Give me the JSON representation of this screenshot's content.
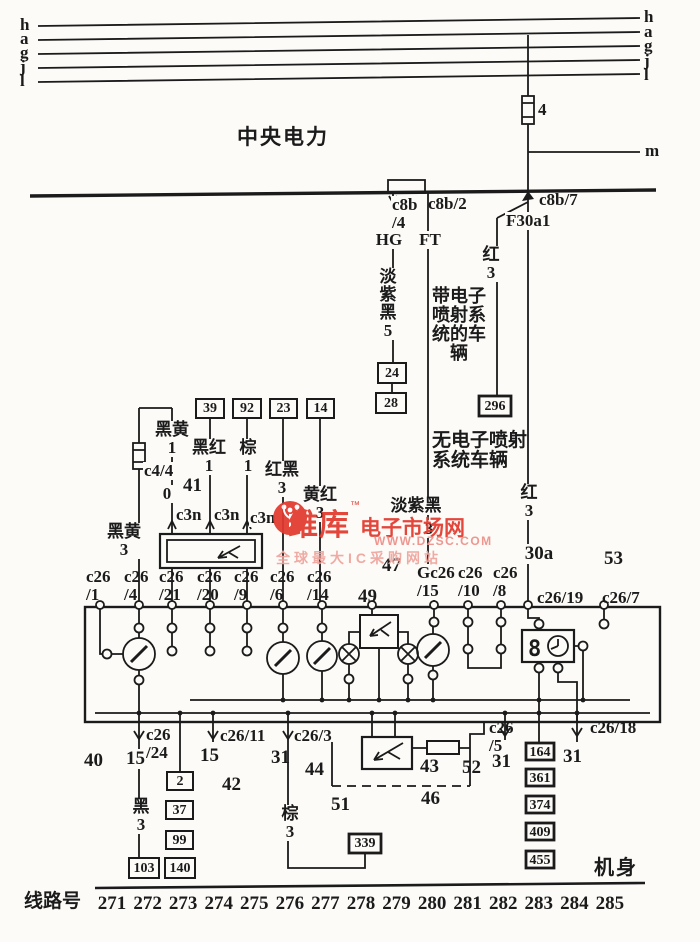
{
  "rails": {
    "left": [
      "h",
      "a",
      "g",
      "j",
      "l"
    ],
    "right": [
      "h",
      "a",
      "g",
      "j",
      "l"
    ],
    "m_label": "m",
    "fuse_label": "4"
  },
  "header": {
    "central_power": "中央电力"
  },
  "c8b": {
    "c8b4": "c8b\n/4",
    "c8b2": "c8b/2",
    "c8b7": "c8b/7",
    "f30a1": "F30a1",
    "hg": "HG",
    "ft": "FT"
  },
  "wires": {
    "light_purple_black_5": "淡紫\n黑\n5",
    "with_efi": "带电子喷射系统的车辆",
    "without_efi": "无电子喷射系统车辆",
    "red_3_upper": "红\n3",
    "red_3_lower": "红\n3",
    "t30a": "30a",
    "black_yellow_1": "黑黄\n1",
    "black_red_1": "黑红\n1",
    "brown_1": "棕\n1",
    "red_black_3": "红黑\n3",
    "yellow_red_3": "黄红\n3",
    "black_yellow_3": "黑黄\n3",
    "c44": "c4/4",
    "c3n": [
      "c3n",
      "c3n",
      "c3n"
    ],
    "light_purple_black_3": "淡紫黑",
    "lpb3_num": "3",
    "black_3": "黑\n3",
    "brown_3": "棕\n3"
  },
  "callouts": {
    "n0": "0",
    "n40": "40",
    "n41": "41",
    "n42": "42",
    "n43": "43",
    "n44": "44",
    "n46": "46",
    "n47": "47",
    "n49": "49",
    "n51": "51",
    "n52": "52",
    "n53": "53",
    "n15a": "15",
    "n15b": "15",
    "n31a": "31",
    "n31b": "31",
    "n31c": "31"
  },
  "boxes": {
    "b24": "24",
    "b28": "28",
    "b296": "296",
    "b39": "39",
    "b92": "92",
    "b23": "23",
    "b14": "14",
    "b2": "2",
    "b37": "37",
    "b99": "99",
    "b103": "103",
    "b140": "140",
    "b339": "339",
    "b164": "164",
    "b361": "361",
    "b374": "374",
    "b409": "409",
    "b455": "455"
  },
  "c26_top": [
    "c26\n/1",
    "c26\n/4",
    "c26\n/21",
    "c26\n/20",
    "c26\n/9",
    "c26\n/6",
    "c26\n/14",
    "Gc26\n/15",
    "c26\n/10",
    "c26\n/8",
    "c26/19",
    "c26/7"
  ],
  "c26_bottom": [
    "c26\n/24",
    "c26/11",
    "c26/3",
    "c26\n/5",
    "c26/18"
  ],
  "clock": {
    "digit": "8"
  },
  "footer": {
    "line_label": "线路号",
    "line_numbers": [
      "271",
      "272",
      "273",
      "274",
      "275",
      "276",
      "277",
      "278",
      "279",
      "280",
      "281",
      "282",
      "283",
      "284",
      "285"
    ],
    "body": "机身"
  },
  "watermark": {
    "brand": "维库",
    "tm": "™",
    "suffix": "电子市场网",
    "url": "WWW.DZSC.COM",
    "tagline": "全球最大IC采购网站"
  }
}
